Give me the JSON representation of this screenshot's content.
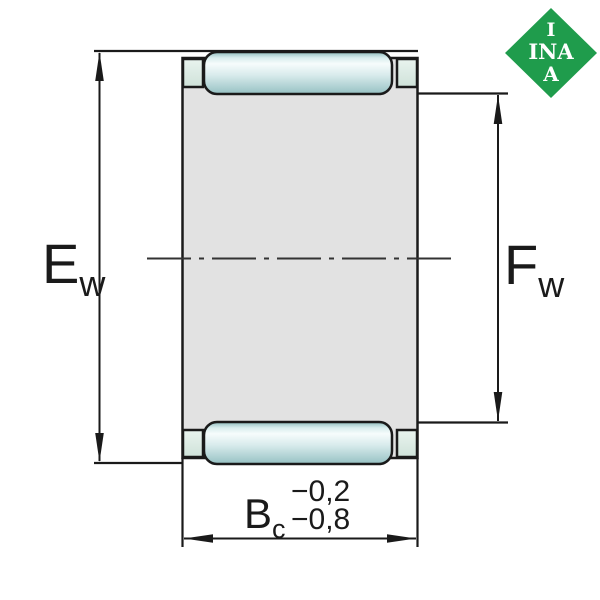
{
  "labels": {
    "ew": {
      "base": "E",
      "sub": "w"
    },
    "fw": {
      "base": "F",
      "sub": "w"
    },
    "bc": {
      "base": "B",
      "sub": "c",
      "tolerance_upper": "−0,2",
      "tolerance_lower": "−0,8"
    }
  },
  "logo": {
    "line1": "I",
    "line2": "INA",
    "line3": "A"
  },
  "colors": {
    "logo_green": "#1f9c4c",
    "body_gray": "#e2e2e2",
    "lip_green": "#d9e9e1",
    "roller_edge_teal": "#8fbcbe",
    "roller_highlight": "#f6fcfc",
    "line_black": "#1a1a1a"
  }
}
